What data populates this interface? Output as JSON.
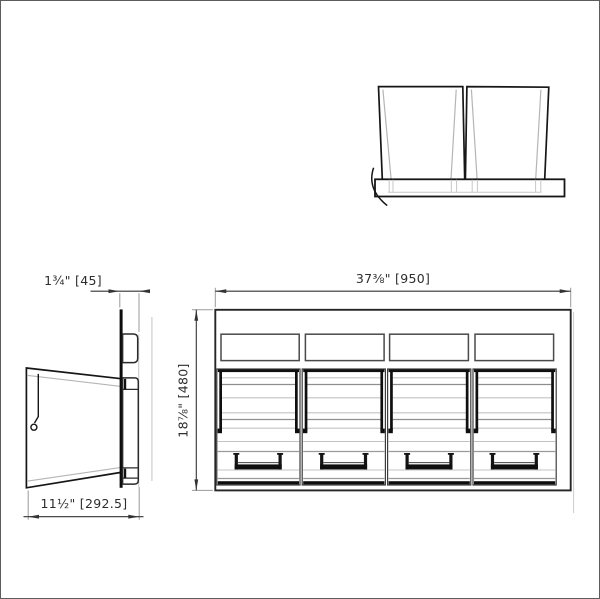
{
  "drawing": {
    "side_view": {
      "panel_thickness_dim": "1¾\" [45]",
      "depth_dim": "11½\" [292.5]"
    },
    "front_view": {
      "width_dim": "37⅜\" [950]",
      "height_dim": "18⅞\" [480]"
    },
    "colors": {
      "line": "#161616",
      "thin_line": "#3d3d3d",
      "light_line": "#c3c3c3",
      "dimension_line": "#333333",
      "background": "#ffffff"
    }
  }
}
